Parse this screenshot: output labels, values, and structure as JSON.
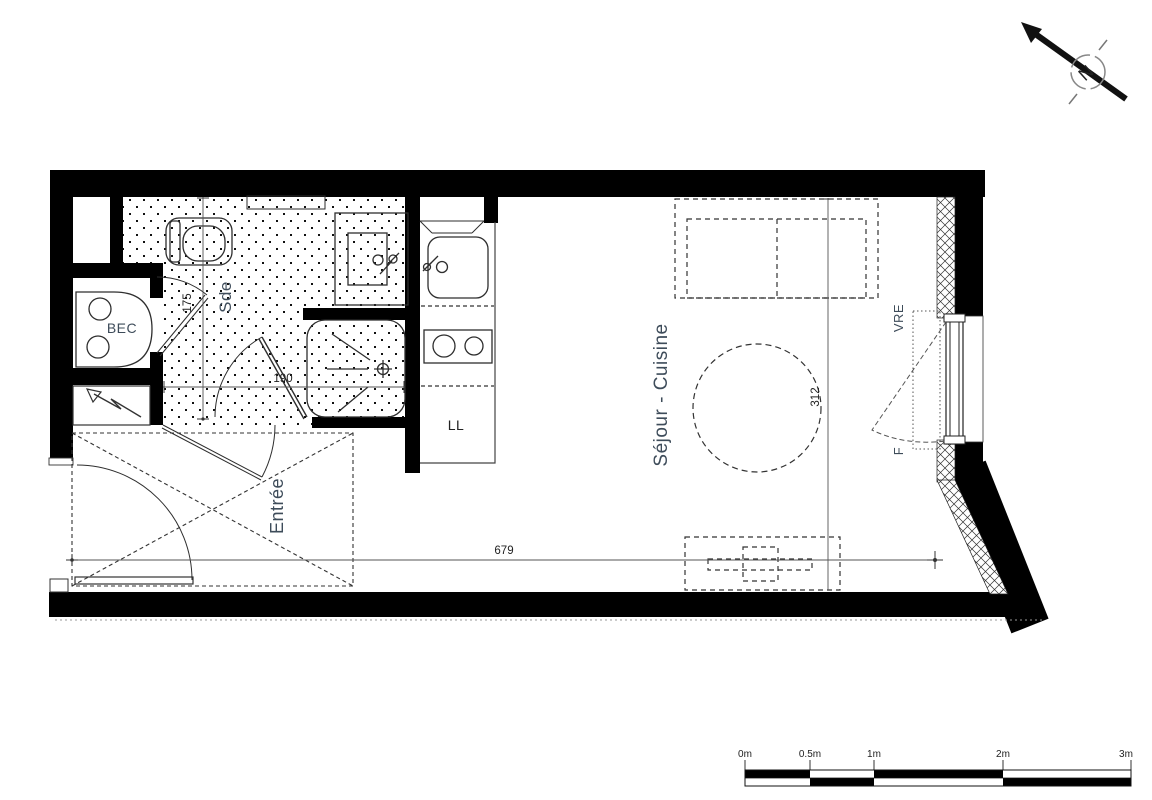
{
  "labels": {
    "bathroom": "Sde",
    "water_heater": "BEC",
    "entry": "Entrée",
    "living_kitchen": "Séjour - Cuisine",
    "washing_machine": "LL",
    "roller_shutter": "VRE",
    "window": "F",
    "north": "N"
  },
  "dimensions": {
    "bathroom_length": "175",
    "bathroom_width": "190",
    "living_depth": "312",
    "apartment_width": "679"
  },
  "scale_bar": {
    "labels": [
      "0m",
      "0.5m",
      "1m",
      "2m",
      "3m"
    ]
  },
  "colors": {
    "wall": "#000000",
    "room_label": "#3e4c5a",
    "dimension_text": "#222222",
    "line": "#2e2e2e"
  }
}
